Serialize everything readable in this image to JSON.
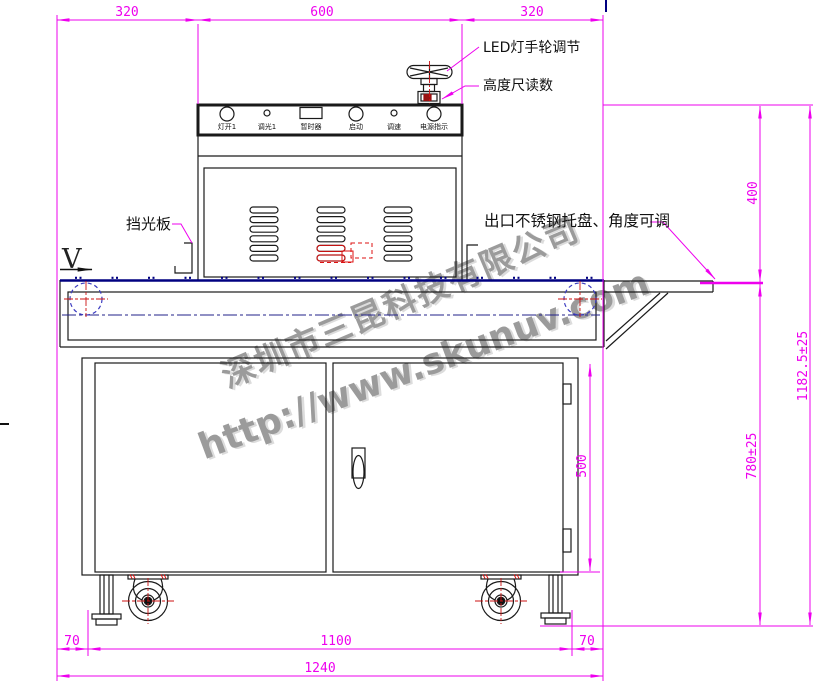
{
  "drawing": {
    "type": "uv-curing-machine-front-view",
    "dims": {
      "top_left": "320",
      "top_mid": "600",
      "top_right": "320",
      "right_upper": "400",
      "right_total": "1182.5±25",
      "right_lower": "780±25",
      "cabinet_height": "500",
      "bottom_left": "70",
      "bottom_mid": "1100",
      "bottom_right": "70",
      "bottom_total": "1240"
    },
    "annotations": {
      "led_handwheel": "LED灯手轮调节",
      "height_gauge": "高度尺读数",
      "light_shield": "挡光板",
      "outlet_tray": "出口不锈钢托盘、角度可调",
      "velocity": "V"
    },
    "panel": {
      "controls": [
        {
          "label": "灯开1",
          "type": "push-button"
        },
        {
          "label": "调光1",
          "type": "knob"
        },
        {
          "label": "暂时器",
          "type": "timer-display"
        },
        {
          "label": "启动",
          "type": "push-button"
        },
        {
          "label": "调速",
          "type": "knob"
        },
        {
          "label": "电源指示",
          "type": "indicator-lamp"
        }
      ]
    },
    "watermark": {
      "company": "深圳市三昆科技有限公司",
      "website": "http://www.skunuv.com"
    },
    "colors": {
      "dimension": "#ee00ee",
      "outline": "#1a1a1a",
      "belt": "#000080",
      "centerline_red": "#cc1111",
      "roller_blue": "#3b3bc0",
      "detail_red": "#dd1111",
      "watermark_gray": "#9b9b9b"
    }
  }
}
